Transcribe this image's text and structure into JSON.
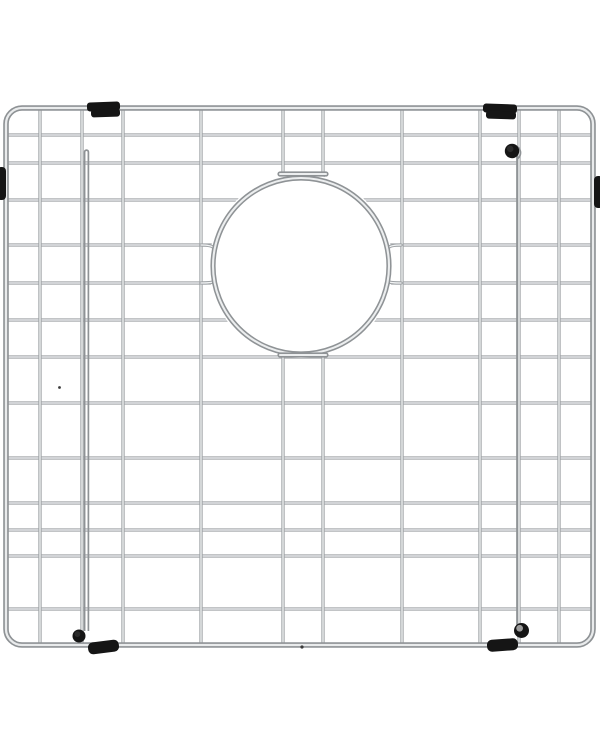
{
  "meta": {
    "alt": "Stainless steel kitchen sink bottom grid with circular drain opening and black rubber bumpers, product photo on white background",
    "width": 600,
    "height": 750,
    "background": "#ffffff"
  },
  "palette": {
    "wire_edge": "#9da1a4",
    "wire_highlight": "#f2f4f5",
    "frame_edge": "#8e9295",
    "frame_highlight": "#e9ebec",
    "ring_edge": "#8f9396",
    "ring_highlight": "#eceeef",
    "rubber": "#151515",
    "rubber_soft": "#2b2b2b",
    "hub_gray": "#9c9c9c",
    "speck": "#3a3a3a",
    "background": "#ffffff"
  },
  "frame": {
    "x": 6,
    "y": 108,
    "width": 587,
    "height": 537,
    "corner_radius": 16,
    "base_width": 5.6,
    "highlight_width": 2.3
  },
  "wires": {
    "span": {
      "x1": 6,
      "x2": 593,
      "y1": 108,
      "y2": 645
    },
    "vertical_x": [
      40,
      82,
      123,
      201,
      283,
      323,
      402,
      480,
      519,
      559
    ],
    "horizontal_y": [
      135,
      163,
      200,
      245,
      283,
      320,
      357,
      403,
      458,
      503,
      530,
      556,
      609
    ],
    "base_width": 3.3,
    "highlight_width": 1.3
  },
  "opening": {
    "cx": 301,
    "cy": 266,
    "r": 88,
    "mask_r": 92,
    "base_width": 5.2,
    "highlight_width": 2.1,
    "top_tab": {
      "x1": 280,
      "x2": 326,
      "y": 174
    },
    "bottom_tab": {
      "x1": 280,
      "x2": 326,
      "y": 355
    },
    "funnels": [
      {
        "name": "ring-funnel-left",
        "d": "M 201,245 C 221,245 213,251 213,266 C 213,281 221,283 201,283"
      },
      {
        "name": "ring-funnel-right",
        "d": "M 401,245 C 381,245 389,251 389,266 C 389,281 381,283 401,283"
      }
    ]
  },
  "legs": {
    "left": {
      "type": "hairpin",
      "x1": 84.6,
      "x2": 88.4,
      "top": 152,
      "bottom": 631,
      "stroke_width": 1.7
    },
    "right": {
      "type": "pin",
      "x": 517,
      "top": 153,
      "bottom": 626,
      "hook": "M 517,159 A 6,6 0 0 0 509.5,146.5",
      "stroke_width": 1.7
    }
  },
  "feet": [
    {
      "name": "left-bottom-foot",
      "cx": 79,
      "cy": 636,
      "r": 6.5,
      "hub": false
    },
    {
      "name": "right-bottom-foot",
      "cx": 521.5,
      "cy": 630.5,
      "r": 7.5,
      "hub": true
    },
    {
      "name": "right-top-knob",
      "cx": 512,
      "cy": 151,
      "r": 7.2,
      "hub": false
    }
  ],
  "bumpers": [
    {
      "name": "top-left-bumper",
      "rotate": -2,
      "parts": [
        [
          87,
          102,
          33,
          9,
          3
        ],
        [
          91,
          109,
          29,
          8,
          3
        ]
      ]
    },
    {
      "name": "top-right-bumper",
      "rotate": 2,
      "parts": [
        [
          483,
          104,
          34,
          9,
          3
        ],
        [
          486,
          111,
          30,
          8,
          3
        ]
      ]
    },
    {
      "name": "bottom-left-bumper",
      "rotate": -7,
      "parts": [
        [
          88,
          641,
          31,
          12,
          5
        ]
      ]
    },
    {
      "name": "bottom-right-bumper",
      "rotate": -4,
      "parts": [
        [
          487,
          639,
          31,
          12,
          5
        ]
      ]
    },
    {
      "name": "left-side-bumper",
      "rotate": 0,
      "parts": [
        [
          -3,
          167,
          9,
          33,
          4
        ]
      ]
    },
    {
      "name": "right-side-bumper",
      "rotate": 0,
      "parts": [
        [
          594,
          176,
          9,
          32,
          4
        ]
      ]
    }
  ],
  "specks": [
    {
      "cx": 59.5,
      "cy": 387.5,
      "r": 1.4
    },
    {
      "cx": 302,
      "cy": 647,
      "r": 1.6
    }
  ]
}
